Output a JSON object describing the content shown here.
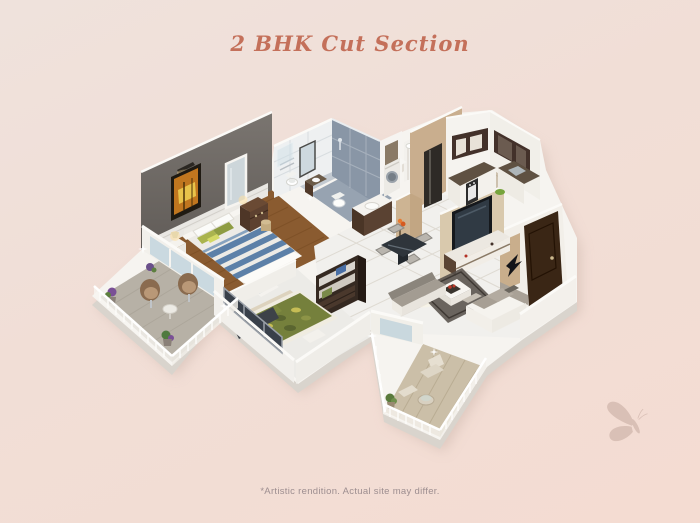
{
  "page": {
    "title": "2 BHK Cut Section",
    "disclaimer": "*Artistic rendition. Actual site may differ."
  },
  "colors": {
    "background_top": "#efe2dc",
    "background_bottom": "#f4dcd2",
    "title_text": "#c4705a",
    "disclaimer_text": "#9d8e90",
    "butterfly_watermark": "#d7bdb3",
    "accent_wall": "#6b6662",
    "wood_floor": "#8a5b30",
    "bath_tile_blue": "#8996a6",
    "kitchen_cabinet": "#43312a",
    "entrance_door": "#3a2615",
    "base_plinth": "#f6f4f0"
  },
  "icons": {
    "butterfly": "butterfly-watermark"
  },
  "floor_plan": {
    "type": "isometric-3d-cutaway",
    "description": "2 BHK apartment cut-section render on white plinth",
    "rooms": [
      {
        "name": "master-bedroom",
        "items": [
          "double-bed-striped-bedding",
          "wall-art",
          "picture-light",
          "dresser",
          "mirror",
          "nightstand-lamps",
          "wicker-basket",
          "gray-accent-wall",
          "wood-floor"
        ]
      },
      {
        "name": "master-bathroom",
        "items": [
          "toilet",
          "vanity-sink",
          "shower-glass",
          "wall-mirror",
          "towel-rail"
        ]
      },
      {
        "name": "common-bathroom",
        "items": [
          "toilet",
          "shower",
          "blue-gray-tile-walls"
        ]
      },
      {
        "name": "utility-passage",
        "items": [
          "washing-machine",
          "wash-basin-counter",
          "louvered-utility-balcony",
          "flower-vase"
        ]
      },
      {
        "name": "kitchen",
        "items": [
          "upper-cabinets",
          "cooktop-oven",
          "sink",
          "green-bowl",
          "beige-entry-wall"
        ]
      },
      {
        "name": "living-dining",
        "items": [
          "wall-tv",
          "tv-console",
          "coffee-table",
          "area-rug",
          "l-sofa",
          "bench-sofa",
          "dining-table-4-chairs",
          "entrance-door",
          "bird-wall-art",
          "white-floor-tiles"
        ]
      },
      {
        "name": "second-bedroom",
        "items": [
          "double-bed-green-bedding",
          "open-wardrobe",
          "window",
          "foot-bench"
        ]
      },
      {
        "name": "balcony-left",
        "items": [
          "two-round-chairs",
          "side-table",
          "potted-plants",
          "white-railing"
        ]
      },
      {
        "name": "balcony-right",
        "items": [
          "lounge-chair",
          "stool",
          "round-table",
          "plant",
          "white-railing",
          "plank-floor"
        ]
      }
    ]
  }
}
